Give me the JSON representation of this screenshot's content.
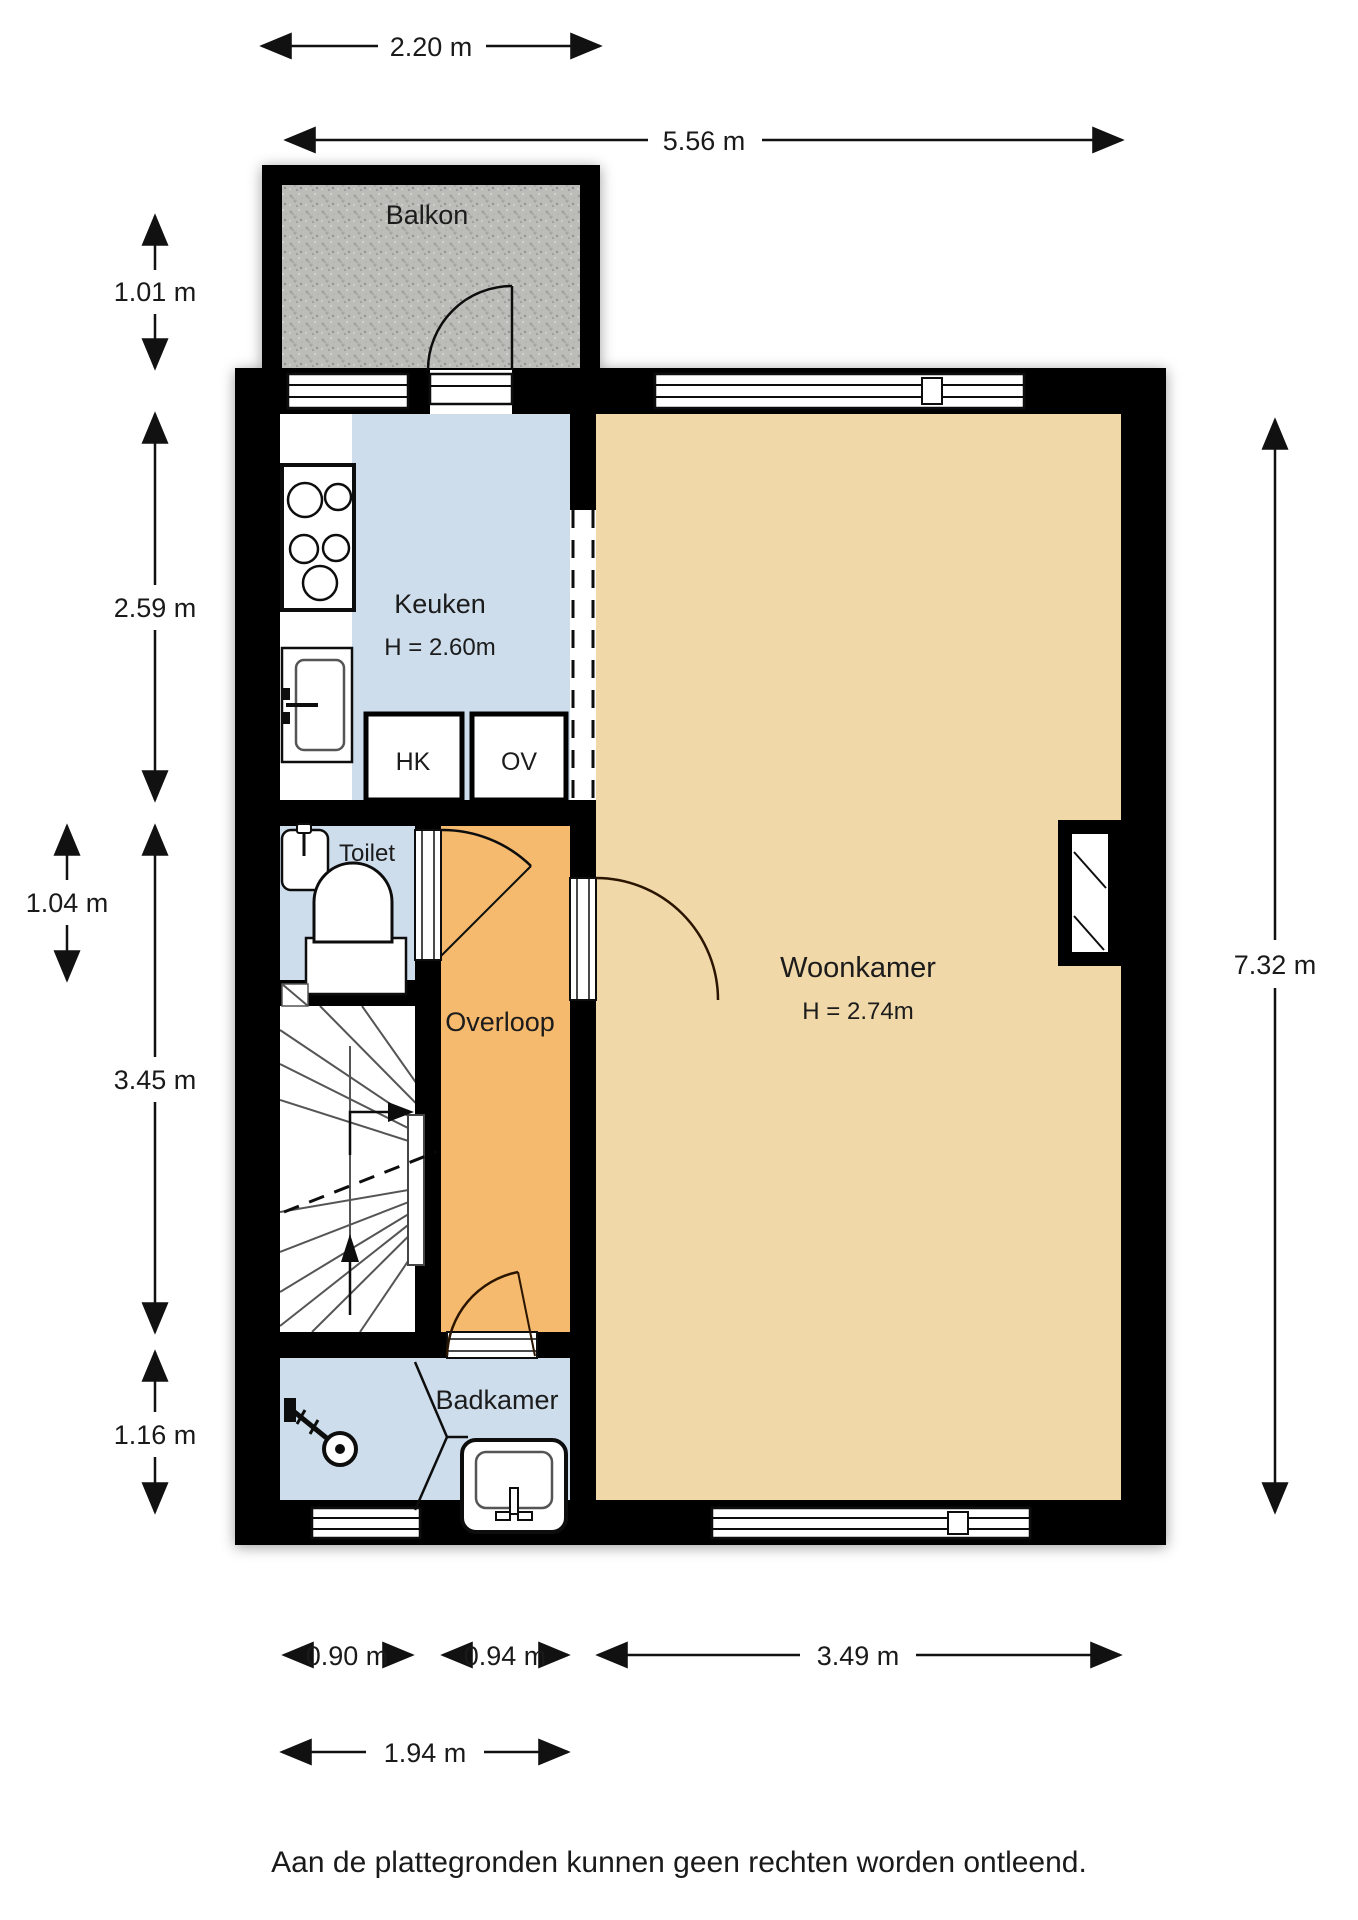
{
  "plan": {
    "rooms": {
      "balkon": {
        "label": "Balkon"
      },
      "keuken": {
        "label": "Keuken",
        "height": "H = 2.60m"
      },
      "hk": {
        "label": "HK"
      },
      "ov": {
        "label": "OV"
      },
      "toilet": {
        "label": "Toilet"
      },
      "overloop": {
        "label": "Overloop"
      },
      "woonkamer": {
        "label": "Woonkamer",
        "height": "H = 2.74m"
      },
      "badkamer": {
        "label": "Badkamer"
      }
    },
    "dimensions": {
      "top_balcony": "2.20 m",
      "top_total": "5.56 m",
      "left_balcony": "1.01 m",
      "left_kitchen": "2.59 m",
      "left_toilet": "1.04 m",
      "left_stairs": "3.45 m",
      "left_bathroom": "1.16 m",
      "right_total": "7.32 m",
      "bottom_bathroom": "0.90 m",
      "bottom_hall": "0.94 m",
      "bottom_living": "3.49 m",
      "bottom_left_total": "1.94 m"
    },
    "colors": {
      "wall": "#000000",
      "wet_room_floor": "#cdddec",
      "living_floor": "#f1d8a8",
      "hall_floor": "#f6ba6e",
      "balcony_base": "#bcbcb8",
      "white_floor": "#ffffff"
    },
    "disclaimer": "Aan de plattegronden kunnen geen rechten worden ontleend."
  }
}
